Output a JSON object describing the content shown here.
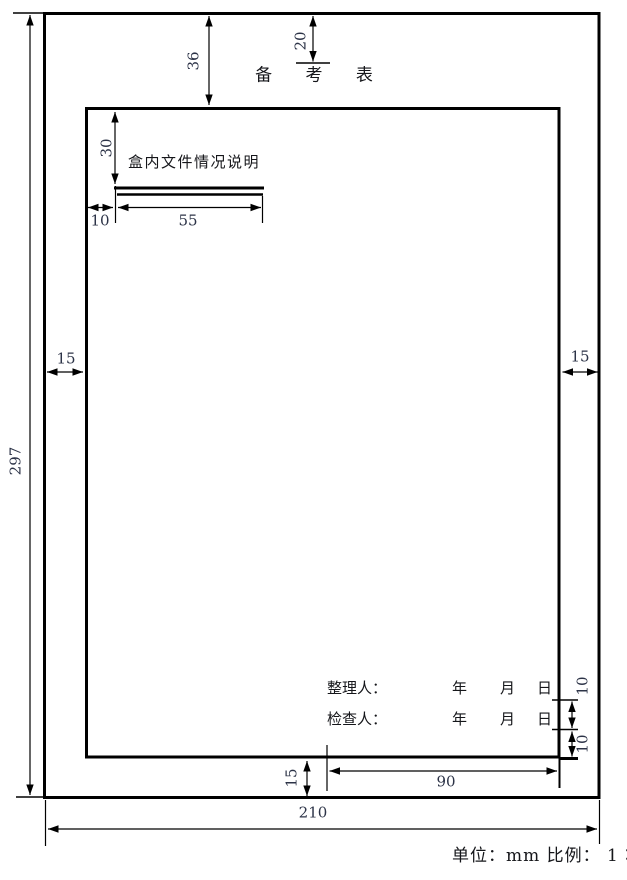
{
  "figure": {
    "title": "备 考 表",
    "note_heading": "盒内文件情况说明",
    "signature_rows": [
      {
        "label": "整理人：",
        "fields": [
          "年",
          "月",
          "日"
        ]
      },
      {
        "label": "检查人：",
        "fields": [
          "年",
          "月",
          "日"
        ]
      }
    ],
    "caption": "单位：mm 比例： 1∶2",
    "dims": {
      "page_height": "297",
      "page_width": "210",
      "margin_top": "36",
      "title_drop": "20",
      "heading_drop": "30",
      "heading_indent": "10",
      "rule_width": "55",
      "margin_left": "15",
      "margin_right": "15",
      "margin_bottom": "15",
      "row_spacing_upper": "10",
      "row_spacing_lower": "10",
      "signature_block_width": "90"
    },
    "colors": {
      "line": "#000000",
      "dim_text": "#2c3347",
      "cjk_text": "#15161a",
      "background": "#ffffff"
    }
  }
}
